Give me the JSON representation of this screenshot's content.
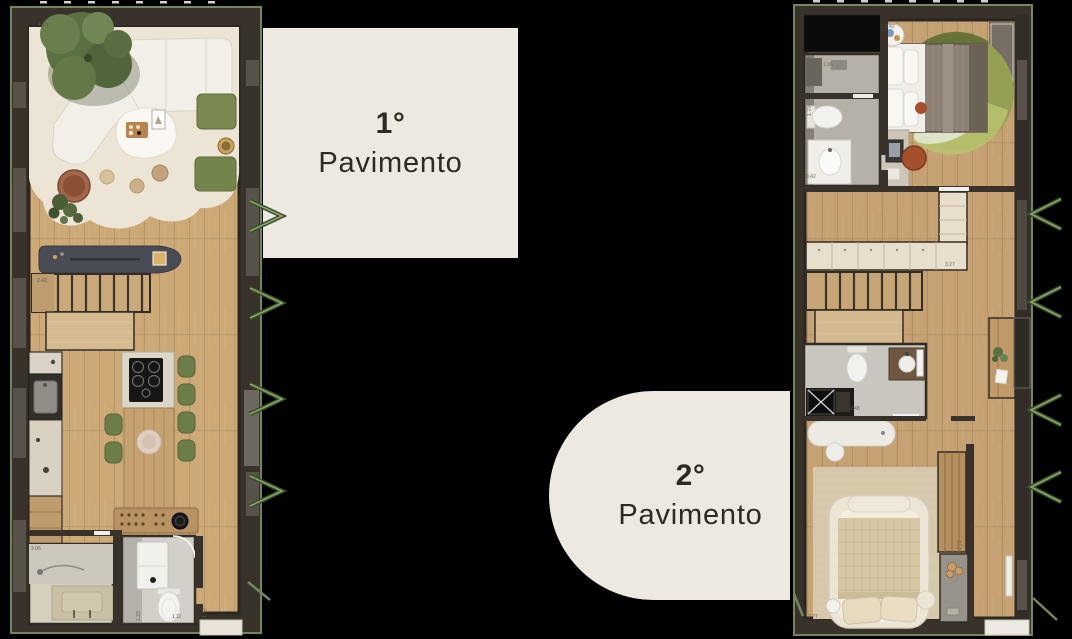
{
  "page": {
    "background": "#000000"
  },
  "floor1": {
    "label": {
      "number": "1°",
      "name": "Pavimento"
    },
    "dims": [
      "4.28",
      "2.42",
      "2.06",
      "1.23",
      "1.42",
      "1.11"
    ]
  },
  "floor2": {
    "label": {
      "number": "2°",
      "name": "Pavimento"
    },
    "dims": [
      "2.42",
      "1.06",
      "1.70",
      "0.42",
      "3.27",
      "2.48",
      "2.72",
      "2.77"
    ]
  },
  "colors": {
    "card_beige": "#EDE8E0",
    "label_text": "#2D2A26",
    "wall_dark": "#38322B",
    "wood_floor": "#CDA977",
    "green_trim": "#73865E",
    "olive_furniture": "#75874E",
    "counter_charcoal": "#4A4C55",
    "terracotta": "#A2664A"
  },
  "icons": {
    "window_awning": "window-awning-icon"
  }
}
